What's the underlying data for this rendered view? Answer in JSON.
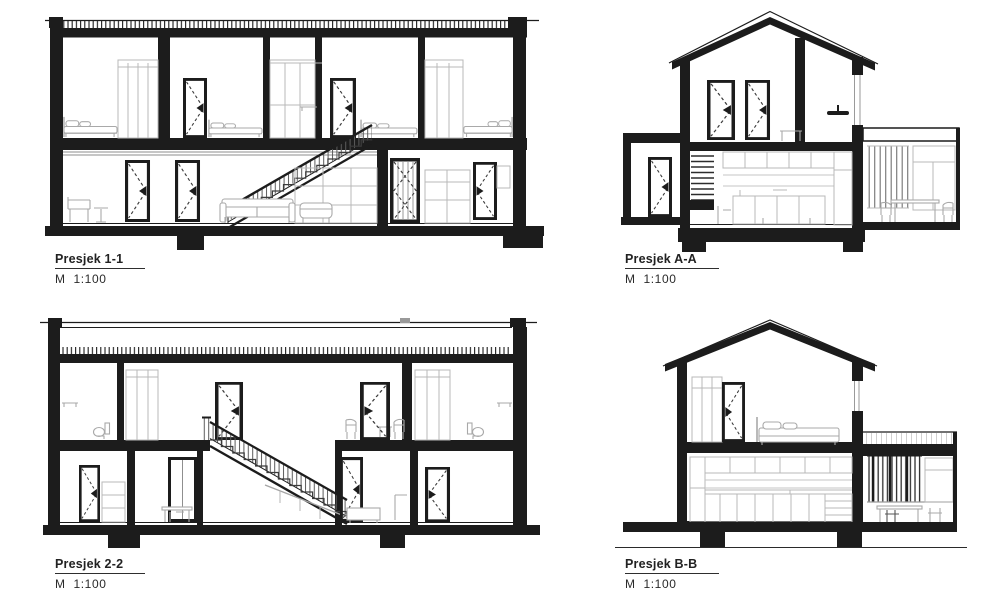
{
  "sheet": {
    "background": "#ffffff",
    "ink_color": "#1c1c1c",
    "furniture_color": "#a9a9a9",
    "dash_color": "#3a3a3a"
  },
  "sections": [
    {
      "id": "1-1",
      "label": "Presjek 1-1",
      "scale": "M  1:100"
    },
    {
      "id": "A-A",
      "label": "Presjek A-A",
      "scale": "M  1:100"
    },
    {
      "id": "2-2",
      "label": "Presjek 2-2",
      "scale": "M  1:100"
    },
    {
      "id": "B-B",
      "label": "Presjek B-B",
      "scale": "M  1:100"
    }
  ]
}
